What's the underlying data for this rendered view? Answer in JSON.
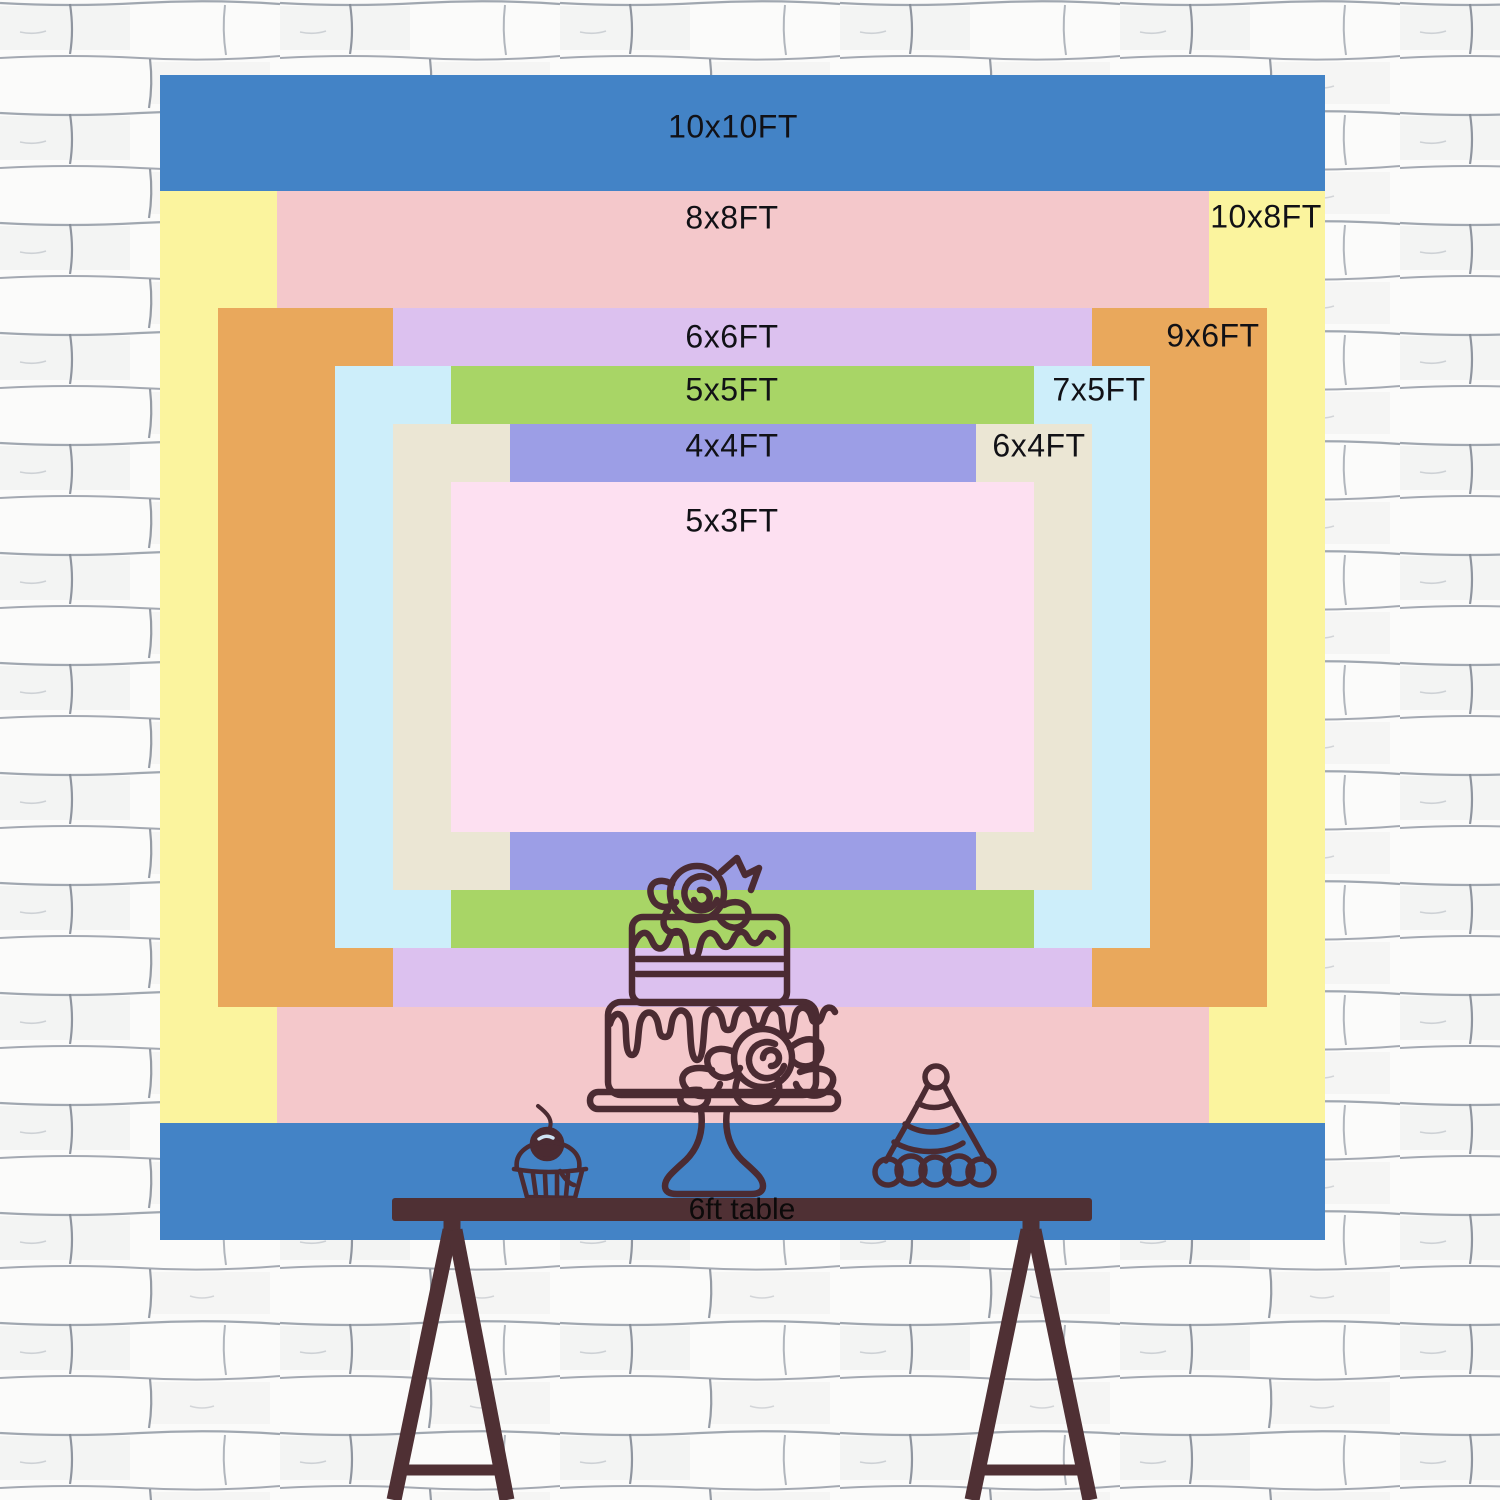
{
  "backdrop": {
    "center_x": 742.5,
    "center_y": 657,
    "px_per_ft": 116.5,
    "sizes": [
      {
        "id": "10x10ft",
        "label": "10x10FT",
        "width_ft": 10,
        "height_ft": 10,
        "color": "#4383c6",
        "label_x": 733,
        "label_y": 127
      },
      {
        "id": "10x8ft",
        "label": "10x8FT",
        "width_ft": 10,
        "height_ft": 8,
        "color": "#fbf49e",
        "label_x": 1266,
        "label_y": 217
      },
      {
        "id": "8x8ft",
        "label": "8x8FT",
        "width_ft": 8,
        "height_ft": 8,
        "color": "#f4c8cb",
        "label_x": 732,
        "label_y": 218
      },
      {
        "id": "9x6ft",
        "label": "9x6FT",
        "width_ft": 9,
        "height_ft": 6,
        "color": "#e9a85c",
        "label_x": 1213,
        "label_y": 336
      },
      {
        "id": "6x6ft",
        "label": "6x6FT",
        "width_ft": 6,
        "height_ft": 6,
        "color": "#dcc1ef",
        "label_x": 732,
        "label_y": 337
      },
      {
        "id": "7x5ft",
        "label": "7x5FT",
        "width_ft": 7,
        "height_ft": 5,
        "color": "#cdeefa",
        "label_x": 1099,
        "label_y": 390
      },
      {
        "id": "5x5ft",
        "label": "5x5FT",
        "width_ft": 5,
        "height_ft": 5,
        "color": "#a8d566",
        "label_x": 732,
        "label_y": 390
      },
      {
        "id": "6x4ft",
        "label": "6x4FT",
        "width_ft": 6,
        "height_ft": 4,
        "color": "#ebe6d4",
        "label_x": 1039,
        "label_y": 446
      },
      {
        "id": "4x4ft",
        "label": "4x4FT",
        "width_ft": 4,
        "height_ft": 4,
        "color": "#9c9ee6",
        "label_x": 732,
        "label_y": 446
      },
      {
        "id": "5x3ft",
        "label": "5x3FT",
        "width_ft": 5,
        "height_ft": 3,
        "color": "#fde0f1",
        "label_x": 732,
        "label_y": 521
      }
    ]
  },
  "table": {
    "label": "6ft table"
  },
  "illustrations": {
    "cake": "two-tier-drip-cake-on-stand",
    "cupcake": "cupcake-with-cherry",
    "party_hat": "striped-party-hat"
  },
  "palette": {
    "table_brown": "#4f3034",
    "line_brown": "#4b2b32",
    "wall_bg": "#fafaf9",
    "wall_line": "#8e95a0",
    "label_color": "#111116"
  }
}
